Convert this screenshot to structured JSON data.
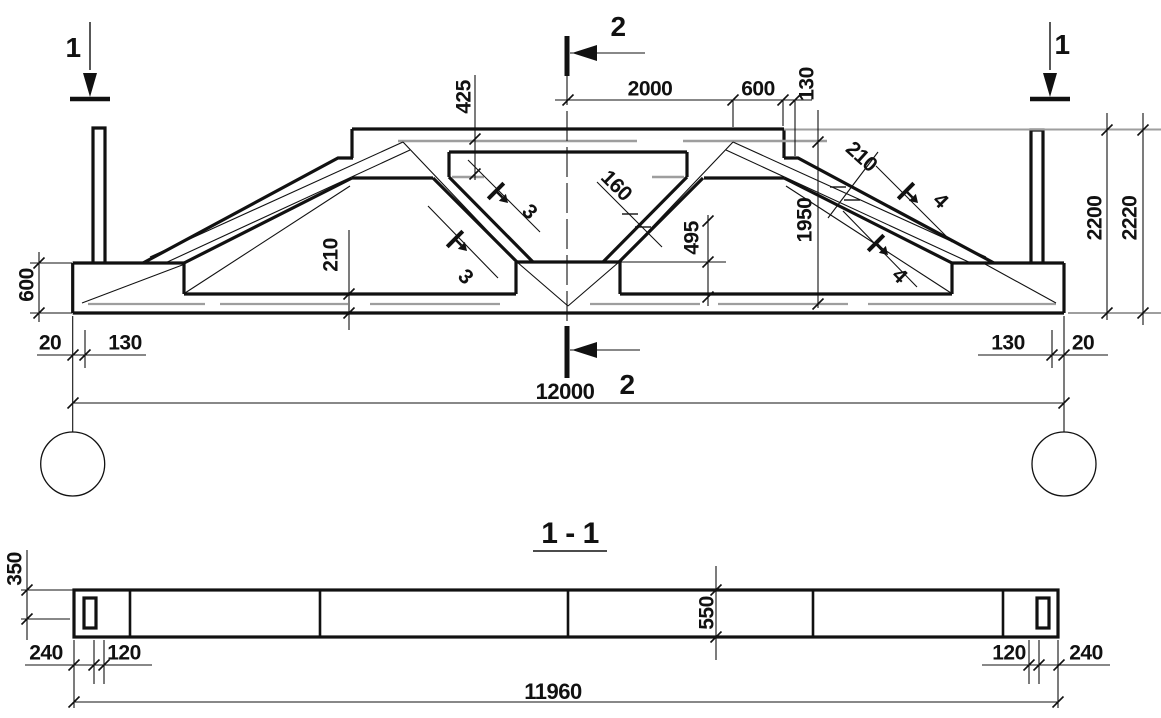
{
  "colors": {
    "ink": "#111111",
    "gray": "#9e9e9e",
    "background": "#ffffff"
  },
  "section_view": {
    "title": "1 - 1"
  },
  "elevation": {
    "section_cut_labels": [
      "1",
      "1",
      "2",
      "2",
      "3",
      "3",
      "4",
      "4"
    ],
    "dimensions_mm": [
      "425",
      "2000",
      "600",
      "130",
      "160",
      "210",
      "1950",
      "495",
      "210",
      "600",
      "2200",
      "2220",
      "20",
      "130",
      "130",
      "20",
      "12000"
    ]
  },
  "plan_section": {
    "dimensions_mm": [
      "350",
      "550",
      "240",
      "120",
      "120",
      "240",
      "11960"
    ]
  },
  "labels": [
    {
      "name": "section-mark-1-left",
      "t": "1",
      "x": 73,
      "y": 47,
      "fs": 28
    },
    {
      "name": "section-mark-1-right",
      "t": "1",
      "x": 1062,
      "y": 44,
      "fs": 28
    },
    {
      "name": "section-mark-2-top",
      "t": "2",
      "x": 618,
      "y": 26,
      "fs": 28
    },
    {
      "name": "section-mark-2-bottom",
      "t": "2",
      "x": 627,
      "y": 384,
      "fs": 28
    },
    {
      "name": "dim-425",
      "t": "425",
      "x": 463,
      "y": 97,
      "r": -90
    },
    {
      "name": "dim-2000",
      "t": "2000",
      "x": 650,
      "y": 88
    },
    {
      "name": "dim-600-top",
      "t": "600",
      "x": 758,
      "y": 88
    },
    {
      "name": "dim-130-top",
      "t": "130",
      "x": 806,
      "y": 84,
      "r": -90
    },
    {
      "name": "dim-160",
      "t": "160",
      "x": 617,
      "y": 185,
      "r": 45
    },
    {
      "name": "dim-210-right",
      "t": "210",
      "x": 862,
      "y": 156,
      "r": 42
    },
    {
      "name": "dim-1950",
      "t": "1950",
      "x": 804,
      "y": 220,
      "r": -90
    },
    {
      "name": "dim-495",
      "t": "495",
      "x": 691,
      "y": 238,
      "r": -90
    },
    {
      "name": "dim-210-left",
      "t": "210",
      "x": 330,
      "y": 255,
      "r": -90
    },
    {
      "name": "dim-600-left",
      "t": "600",
      "x": 26,
      "y": 285,
      "r": -90
    },
    {
      "name": "dim-2200",
      "t": "2200",
      "x": 1094,
      "y": 218,
      "r": -90
    },
    {
      "name": "dim-2220",
      "t": "2220",
      "x": 1129,
      "y": 218,
      "r": -90
    },
    {
      "name": "section-mark-3-upper",
      "t": "3",
      "x": 530,
      "y": 211,
      "r": 45
    },
    {
      "name": "section-mark-3-lower",
      "t": "3",
      "x": 466,
      "y": 276,
      "r": 45
    },
    {
      "name": "section-mark-4-upper",
      "t": "4",
      "x": 941,
      "y": 200,
      "r": 45
    },
    {
      "name": "section-mark-4-lower",
      "t": "4",
      "x": 900,
      "y": 275,
      "r": 45
    },
    {
      "name": "dim-20-left",
      "t": "20",
      "x": 50,
      "y": 342
    },
    {
      "name": "dim-130-botleft",
      "t": "130",
      "x": 125,
      "y": 342
    },
    {
      "name": "dim-130-botright",
      "t": "130",
      "x": 1008,
      "y": 342
    },
    {
      "name": "dim-20-right",
      "t": "20",
      "x": 1083,
      "y": 342
    },
    {
      "name": "dim-12000",
      "t": "12000",
      "x": 565,
      "y": 391,
      "fs": 22
    },
    {
      "name": "dim-350",
      "t": "350",
      "x": 14,
      "y": 569,
      "r": -90
    },
    {
      "name": "dim-550",
      "t": "550",
      "x": 706,
      "y": 613,
      "r": -90
    },
    {
      "name": "dim-240-left",
      "t": "240",
      "x": 46,
      "y": 652
    },
    {
      "name": "dim-120-left",
      "t": "120",
      "x": 124,
      "y": 652
    },
    {
      "name": "dim-120-right",
      "t": "120",
      "x": 1009,
      "y": 652
    },
    {
      "name": "dim-240-right",
      "t": "240",
      "x": 1086,
      "y": 652
    },
    {
      "name": "dim-11960",
      "t": "11960",
      "x": 553,
      "y": 691,
      "fs": 22
    }
  ]
}
